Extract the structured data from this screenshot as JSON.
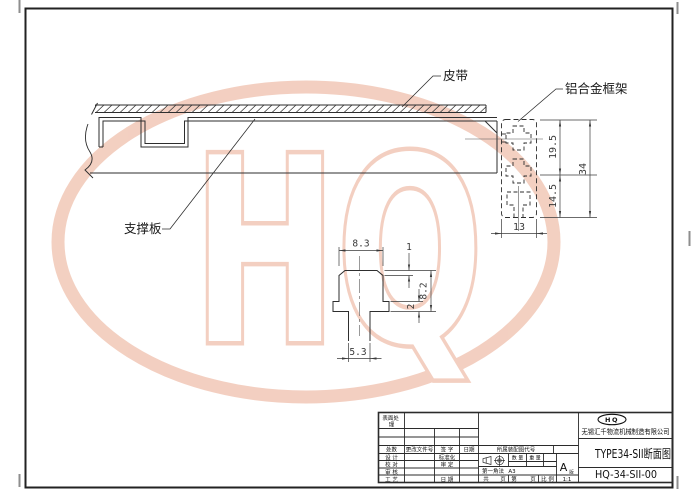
{
  "watermark": {
    "text": "HQ",
    "color": "#e8a184"
  },
  "drawing": {
    "part_labels": {
      "belt": "皮带",
      "frame": "铝合金框架",
      "support_plate": "支撑板"
    },
    "profile_dims": {
      "upper": "19.5",
      "lower": "14.5",
      "total": "34",
      "width": "13"
    },
    "detail_dims": {
      "top_width": "8.3",
      "lip": "1",
      "depth": "8.2",
      "step": "2",
      "neck": "5.3"
    }
  },
  "title_block": {
    "surface_treatment_line1": "表面处",
    "surface_treatment_line2": "理",
    "revision_headers": [
      "处数",
      "更改文件号",
      "签 字",
      "日期"
    ],
    "signoff": {
      "design": "设 计",
      "check": "校 对",
      "review": "审 核",
      "process": "工 艺",
      "standardization": "标准化",
      "approve": "审 定",
      "date": "日 期"
    },
    "assembly_code_label": "所属装配图代号",
    "projection_method": "第一角法",
    "sheet_format": "A3",
    "quantity_label": "数 量",
    "weight_label": "重 量",
    "revision_letter": "A",
    "revision_suffix": "版",
    "total_label": "共",
    "total_suffix": "页",
    "page_label": "第",
    "page_suffix": "页",
    "scale_label": "比 例",
    "scale_value": "1:1",
    "company": "无锡汇千物流机械制造有限公司",
    "logo_text": "HQ",
    "drawing_title": "TYPE34-SII断面图",
    "drawing_number": "HQ-34-SII-00"
  }
}
